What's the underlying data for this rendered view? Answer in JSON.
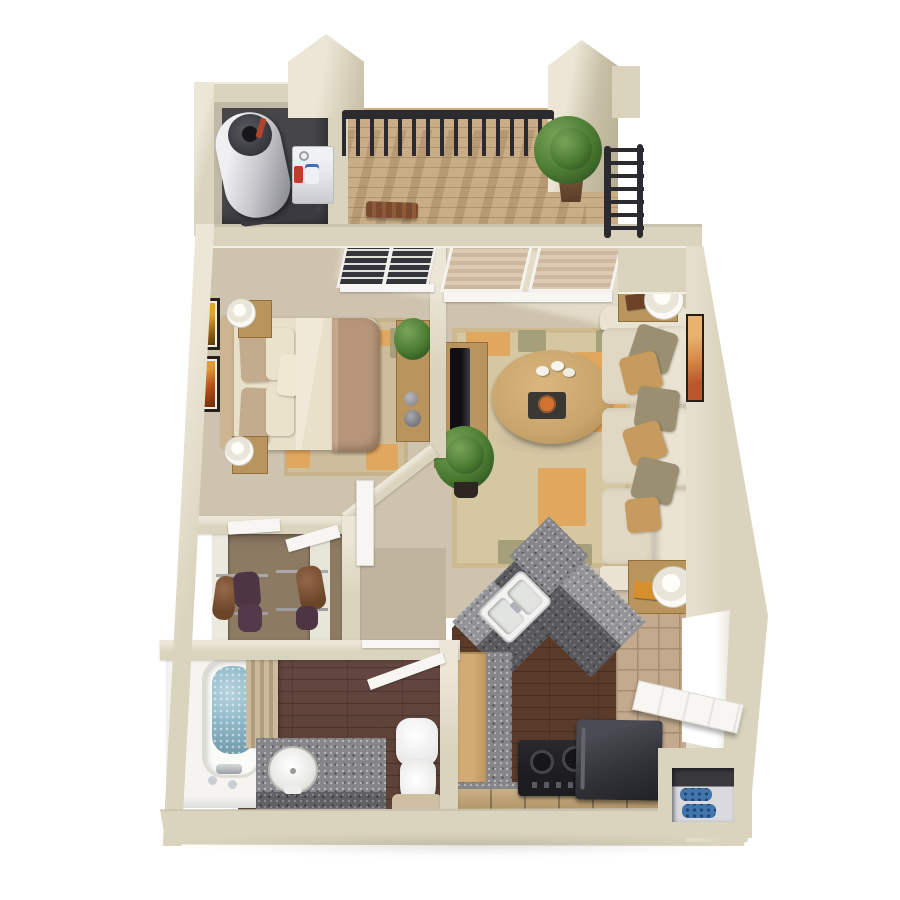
{
  "scene": {
    "type": "3d-floor-plan-render",
    "description": "Photorealistic top-down 3D rendering of a one-bedroom, one-bathroom apartment floor plan with balcony; no text labels visible",
    "background": "#ffffff"
  },
  "palette": {
    "wall": "#dad3bd",
    "wallLight": "#ebe6d6",
    "wallDark": "#c2ba9f",
    "carpet": "#cec3ae",
    "carpetHall": "#c0b49e",
    "closetFloor": "#8c7a62",
    "bathWood": "#5d4237",
    "kitchenWood": "#5a3b2a",
    "balconyWood": "#c9ad86",
    "tile": "#c3a98d",
    "grout": "#a78e71",
    "granite": "#85858a",
    "graniteDark": "#5f5f64",
    "utilFloor": "#46464a",
    "railing": "#2a2a2f",
    "doorWhite": "#f7f6f3",
    "white": "#f5f4f0",
    "sofa": "#eae3d1",
    "cushion": "#e0d8c3",
    "pillowOlive": "#9a9071",
    "pillowTan": "#c69b5d",
    "furnWood": "#b9945d",
    "furnWoodDark": "#8f6f3e",
    "rugBase": "#d6c7a3",
    "rugOrange": "#e0a75e",
    "rugOlive": "#a6a07a",
    "blanket": "#b69579",
    "sheet": "#e9e0ca",
    "bedPillowTan": "#c3ac8d",
    "bedPillowCream": "#ebe2cc",
    "headboard": "#cdb592",
    "green": "#4a7a31",
    "greenDark": "#2c5120",
    "pot": "#6a4a32",
    "water": "#8fb9c8",
    "waterDeep": "#6d96a6",
    "appliance": "#1d1d20",
    "fridge": "#34353b",
    "shoeBlue": "#4076a9",
    "frame": "#261f18",
    "mat": "#f2efe6",
    "artYellow": "#dfa42c",
    "artRust": "#b34f16"
  },
  "rooms": [
    {
      "id": "balcony",
      "name": "balcony",
      "items": [
        "metal-railing",
        "potted-plant",
        "wood-bench",
        "wood-deck-floor"
      ]
    },
    {
      "id": "utility-closet",
      "name": "utility closet",
      "items": [
        "water-heater",
        "washer-unit",
        "detergent-bottles"
      ]
    },
    {
      "id": "bedroom",
      "name": "bedroom",
      "items": [
        "bed",
        "nightstand-top",
        "nightstand-bottom",
        "table-lamp-top",
        "table-lamp-bottom",
        "wall-picture-1",
        "wall-picture-2",
        "area-rug",
        "dresser",
        "dresser-plant",
        "window-with-blinds"
      ]
    },
    {
      "id": "living-room",
      "name": "living room",
      "items": [
        "sofa",
        "throw-pillows",
        "end-table-top",
        "end-table-bottom",
        "table-lamps",
        "coffee-table",
        "decor-eggs",
        "decor-tray",
        "area-rug",
        "tv-stand",
        "tv",
        "shrub-plant",
        "wall-picture",
        "sliding-glass-door-with-blinds"
      ]
    },
    {
      "id": "closet",
      "name": "walk-in closet",
      "items": [
        "hanging-clothes",
        "closet-rods",
        "white-return-walls"
      ]
    },
    {
      "id": "hallway",
      "name": "hallway",
      "items": [
        "bedroom-door",
        "closet-door-panels",
        "bathroom-door"
      ]
    },
    {
      "id": "bathroom",
      "name": "bathroom",
      "items": [
        "bathtub-with-water",
        "slat-screen",
        "granite-vanity",
        "oval-sink",
        "toilet",
        "bath-mat"
      ]
    },
    {
      "id": "kitchen",
      "name": "kitchen",
      "items": [
        "angled-granite-counter",
        "double-sink",
        "stove",
        "refrigerator",
        "wood-cabinets",
        "tile-entry-floor",
        "entry-door",
        "shoe-cubby-with-blue-shoes"
      ]
    }
  ]
}
